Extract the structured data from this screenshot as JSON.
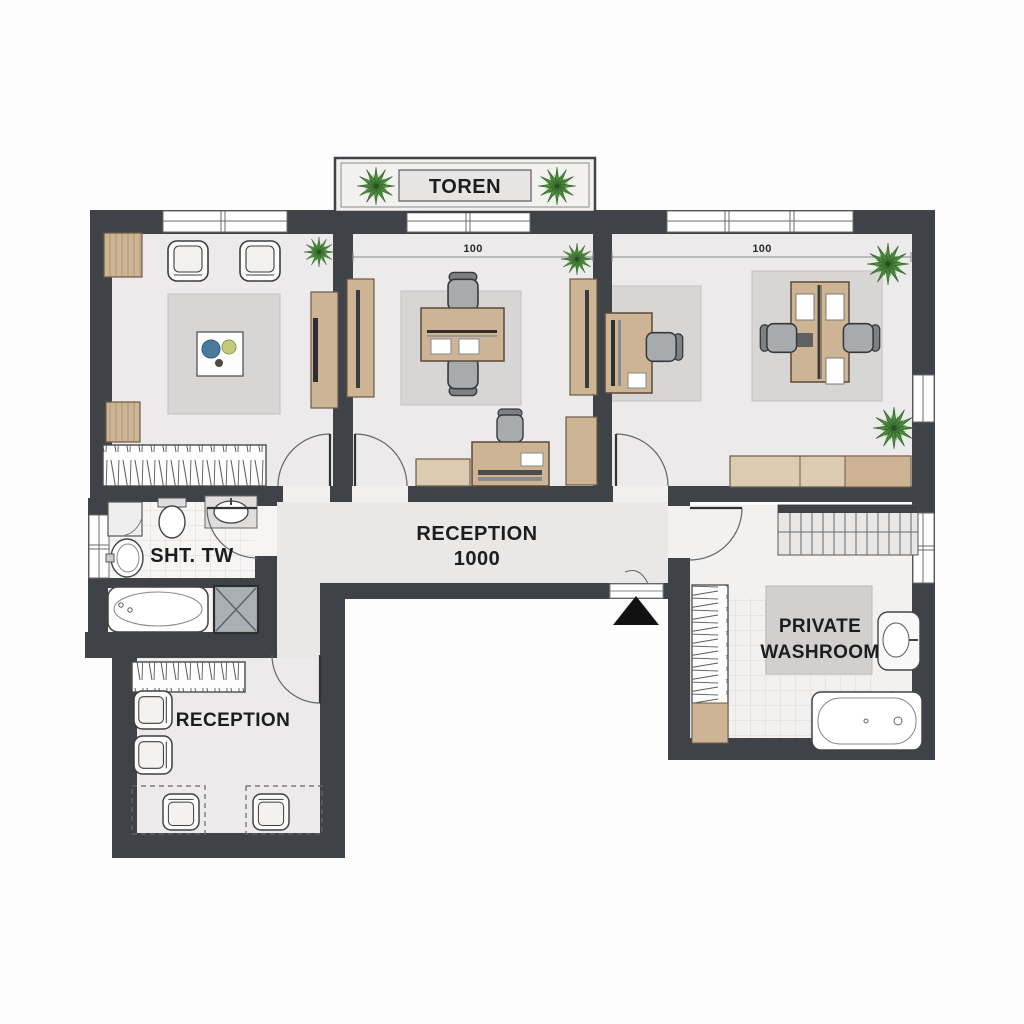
{
  "floorplan": {
    "balcony": {
      "label": "TOREN"
    },
    "office_middle": {
      "dimension": "100"
    },
    "office_right": {
      "dimension": "100"
    },
    "hallway": {
      "label_line1": "RECEPTION",
      "label_line2": "1000"
    },
    "bathroom": {
      "label": "SHT. TW"
    },
    "private_washroom": {
      "label_line1": "PRIVATE",
      "label_line2": "WASHROOM"
    },
    "reception_room": {
      "label": "RECEPTION"
    },
    "colors": {
      "wall": "#3f4347",
      "wood": "#cdb495",
      "wood_light": "#ddcbb1",
      "plant_green": "#4a8a3a",
      "floor": "#eceaea",
      "rug": "#d8d6d4",
      "bowl_blue": "#4a7b9d",
      "shower_gray": "#a9b0b4"
    }
  }
}
